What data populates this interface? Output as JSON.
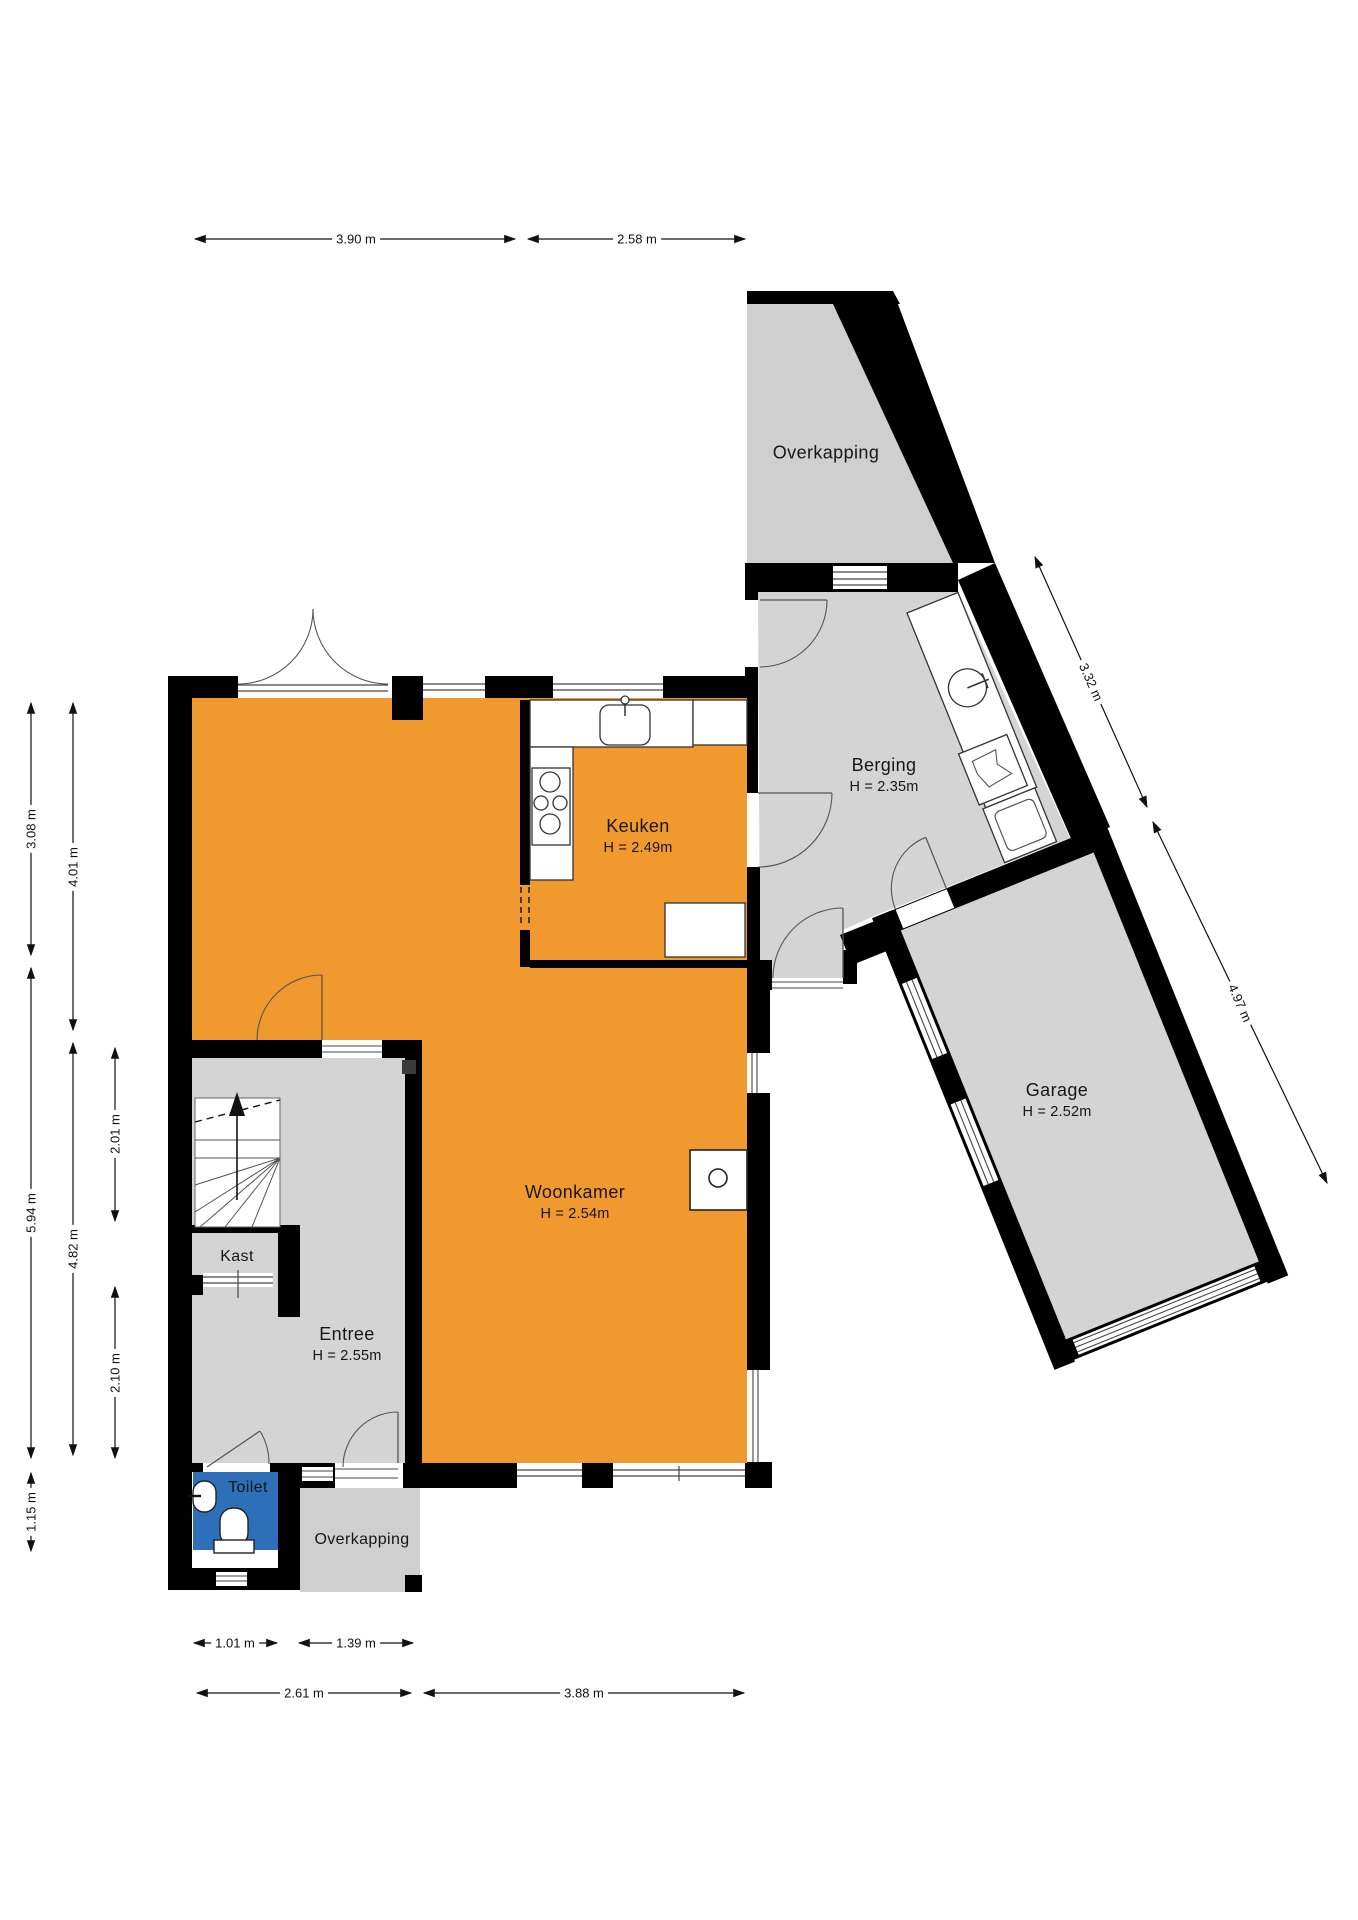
{
  "plan_type": "floorplan",
  "colors": {
    "accent_orange": "#F0992E",
    "room_gray": "#D4D4D4",
    "outdoor_gray": "#CFCFCF",
    "toilet_blue": "#2E6FBA",
    "wall_black": "#000000"
  },
  "rooms": {
    "overkapping_top": {
      "name": "Overkapping"
    },
    "berging": {
      "name": "Berging",
      "height": "H = 2.35m"
    },
    "garage": {
      "name": "Garage",
      "height": "H = 2.52m"
    },
    "keuken": {
      "name": "Keuken",
      "height": "H = 2.49m"
    },
    "woonkamer": {
      "name": "Woonkamer",
      "height": "H = 2.54m"
    },
    "entree": {
      "name": "Entree",
      "height": "H = 2.55m"
    },
    "kast": {
      "name": "Kast"
    },
    "toilet": {
      "name": "Toilet"
    },
    "overkapping_bottom": {
      "name": "Overkapping"
    }
  },
  "dimensions": {
    "top": [
      {
        "label": "3.90 m"
      },
      {
        "label": "2.58 m"
      }
    ],
    "left": [
      {
        "label": "3.08 m"
      },
      {
        "label": "4.01 m"
      },
      {
        "label": "5.94 m"
      },
      {
        "label": "4.82 m"
      },
      {
        "label": "2.01 m"
      },
      {
        "label": "2.10 m"
      },
      {
        "label": "1.15 m"
      }
    ],
    "right": [
      {
        "label": "3.32 m"
      },
      {
        "label": "4.97 m"
      }
    ],
    "bottom": [
      {
        "label": "1.01 m"
      },
      {
        "label": "1.39 m"
      },
      {
        "label": "2.61 m"
      },
      {
        "label": "3.88 m"
      }
    ]
  }
}
